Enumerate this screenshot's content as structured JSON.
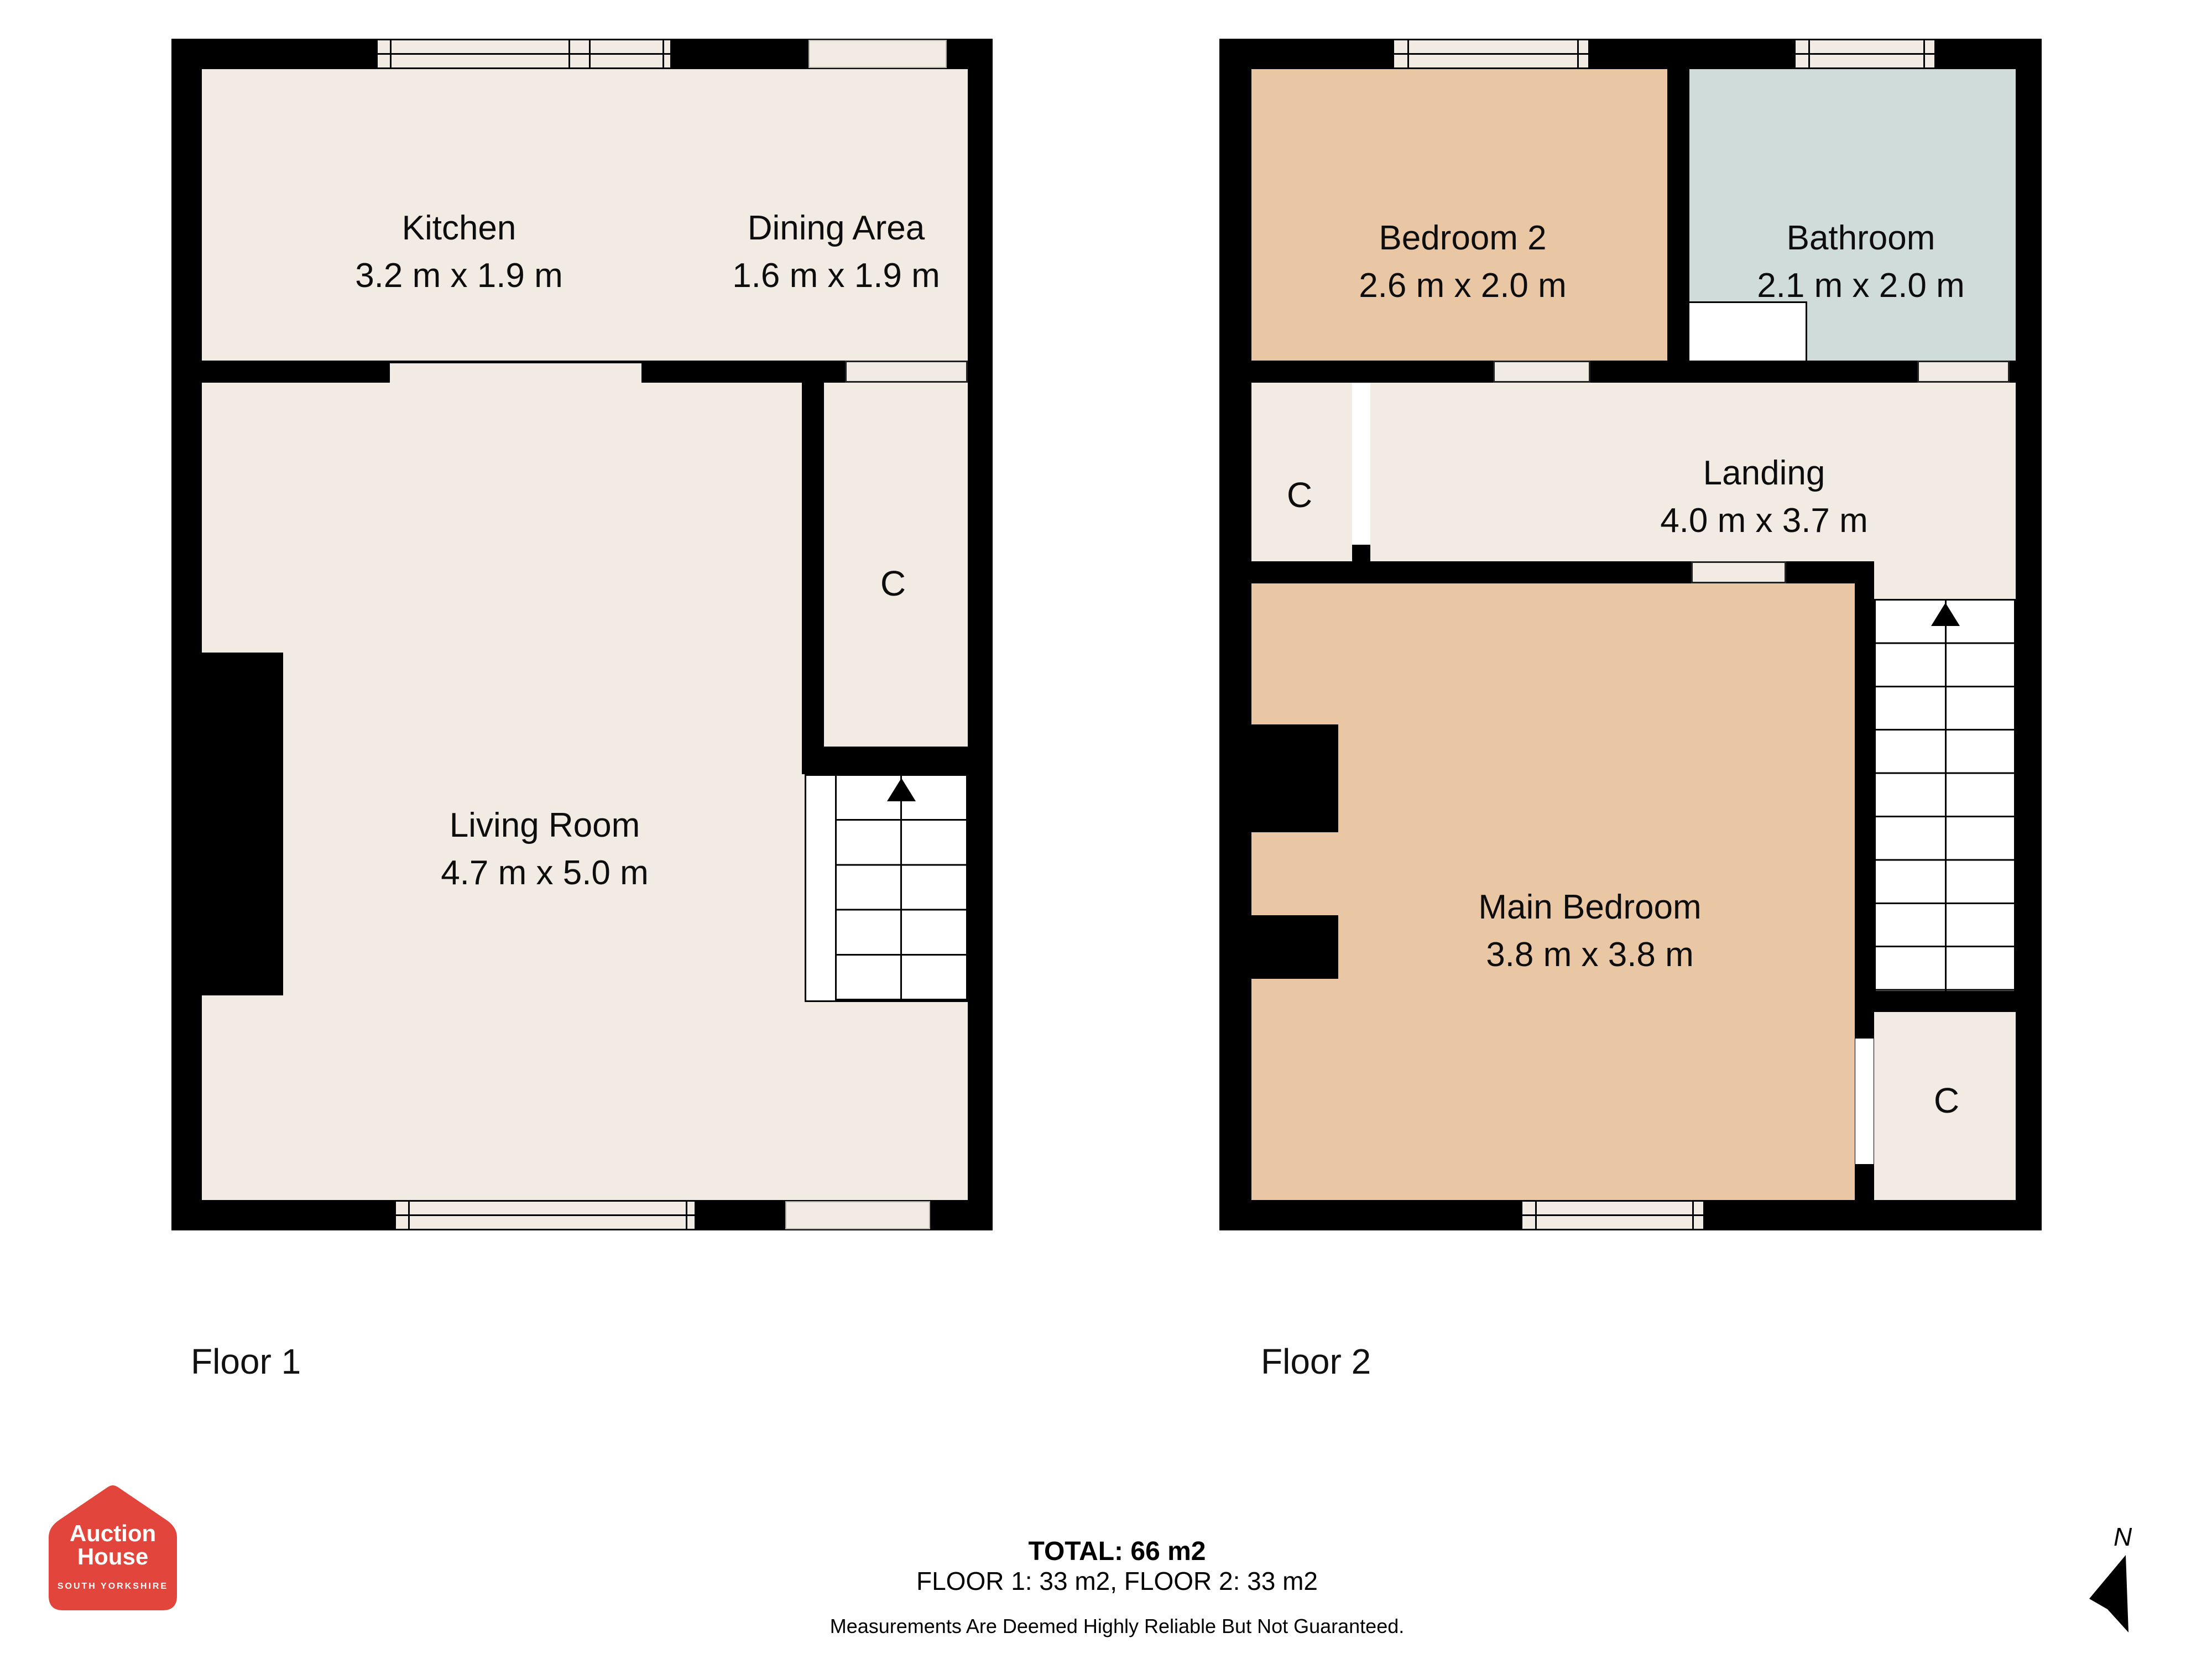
{
  "floor1": {
    "label": "Floor 1",
    "rooms": {
      "kitchen": {
        "name": "Kitchen",
        "dims": "3.2 m x 1.9 m"
      },
      "dining": {
        "name": "Dining Area",
        "dims": "1.6 m x 1.9 m"
      },
      "living": {
        "name": "Living Room",
        "dims": "4.7 m x 5.0 m"
      },
      "closet": {
        "name": "C"
      }
    }
  },
  "floor2": {
    "label": "Floor 2",
    "rooms": {
      "bedroom2": {
        "name": "Bedroom 2",
        "dims": "2.6 m x 2.0 m"
      },
      "bathroom": {
        "name": "Bathroom",
        "dims": "2.1 m x 2.0 m"
      },
      "landing": {
        "name": "Landing",
        "dims": "4.0 m x 3.7 m"
      },
      "main_bedroom": {
        "name": "Main Bedroom",
        "dims": "3.8 m x 3.8 m"
      },
      "closet_landing": {
        "name": "C"
      },
      "closet_bottom": {
        "name": "C"
      }
    }
  },
  "footer": {
    "total": "TOTAL: 66 m2",
    "floors": "FLOOR 1: 33 m2, FLOOR 2: 33 m2",
    "disclaimer": "Measurements Are Deemed Highly Reliable But Not Guaranteed."
  },
  "logo": {
    "line1": "Auction",
    "line2": "House",
    "line3": "SOUTH YORKSHIRE"
  },
  "compass": {
    "north_label": "N"
  },
  "colors": {
    "floor": "#f2ebe3",
    "bedroom": "#e9c7a5",
    "bathroom": "#cfdcda",
    "wall": "#000000",
    "logo_red": "#e2453c",
    "stairs_white": "#ffffff"
  }
}
